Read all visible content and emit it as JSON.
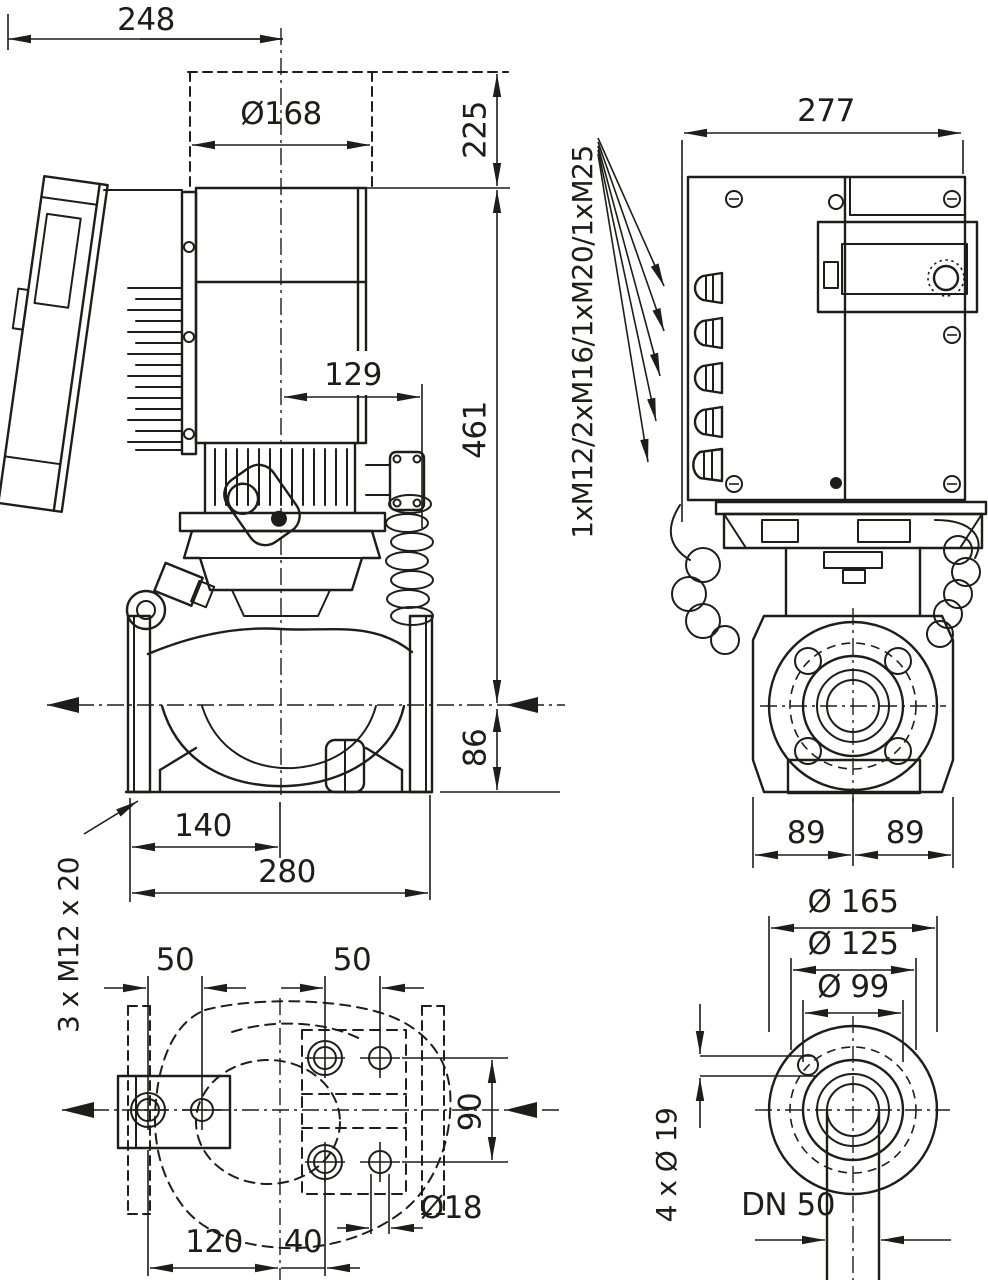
{
  "drawing": {
    "title": "pump-dimensional-drawing",
    "colors": {
      "line": "#1d1d1b",
      "background": "#ffffff"
    },
    "side_view": {
      "overall_depth": "248",
      "motor_diameter": "Ø168",
      "module_height": "225",
      "center_to_coil": "129",
      "center_to_top": "461",
      "center_to_base": "86",
      "foot_to_center": "140",
      "port_to_port": "280",
      "foot_bolt_note": "3 x M12 x 20"
    },
    "rear_view": {
      "overall_width": "277",
      "cable_glands": "1xM12/2xM16/1xM20/1xM25",
      "half_width_left": "89",
      "half_width_right": "89"
    },
    "base_view": {
      "hole_pitch_left": "50",
      "hole_pitch_right": "50",
      "hole_pitch_vertical": "90",
      "hole_diameter": "Ø18",
      "pitch_long": "120",
      "pitch_short": "40"
    },
    "flange_view": {
      "flange_outer_diameter": "Ø 165",
      "bolt_circle_diameter": "Ø 125",
      "raised_face_diameter": "Ø 99",
      "bolt_holes": "4 x Ø 19",
      "nominal_bore": "DN 50"
    }
  }
}
